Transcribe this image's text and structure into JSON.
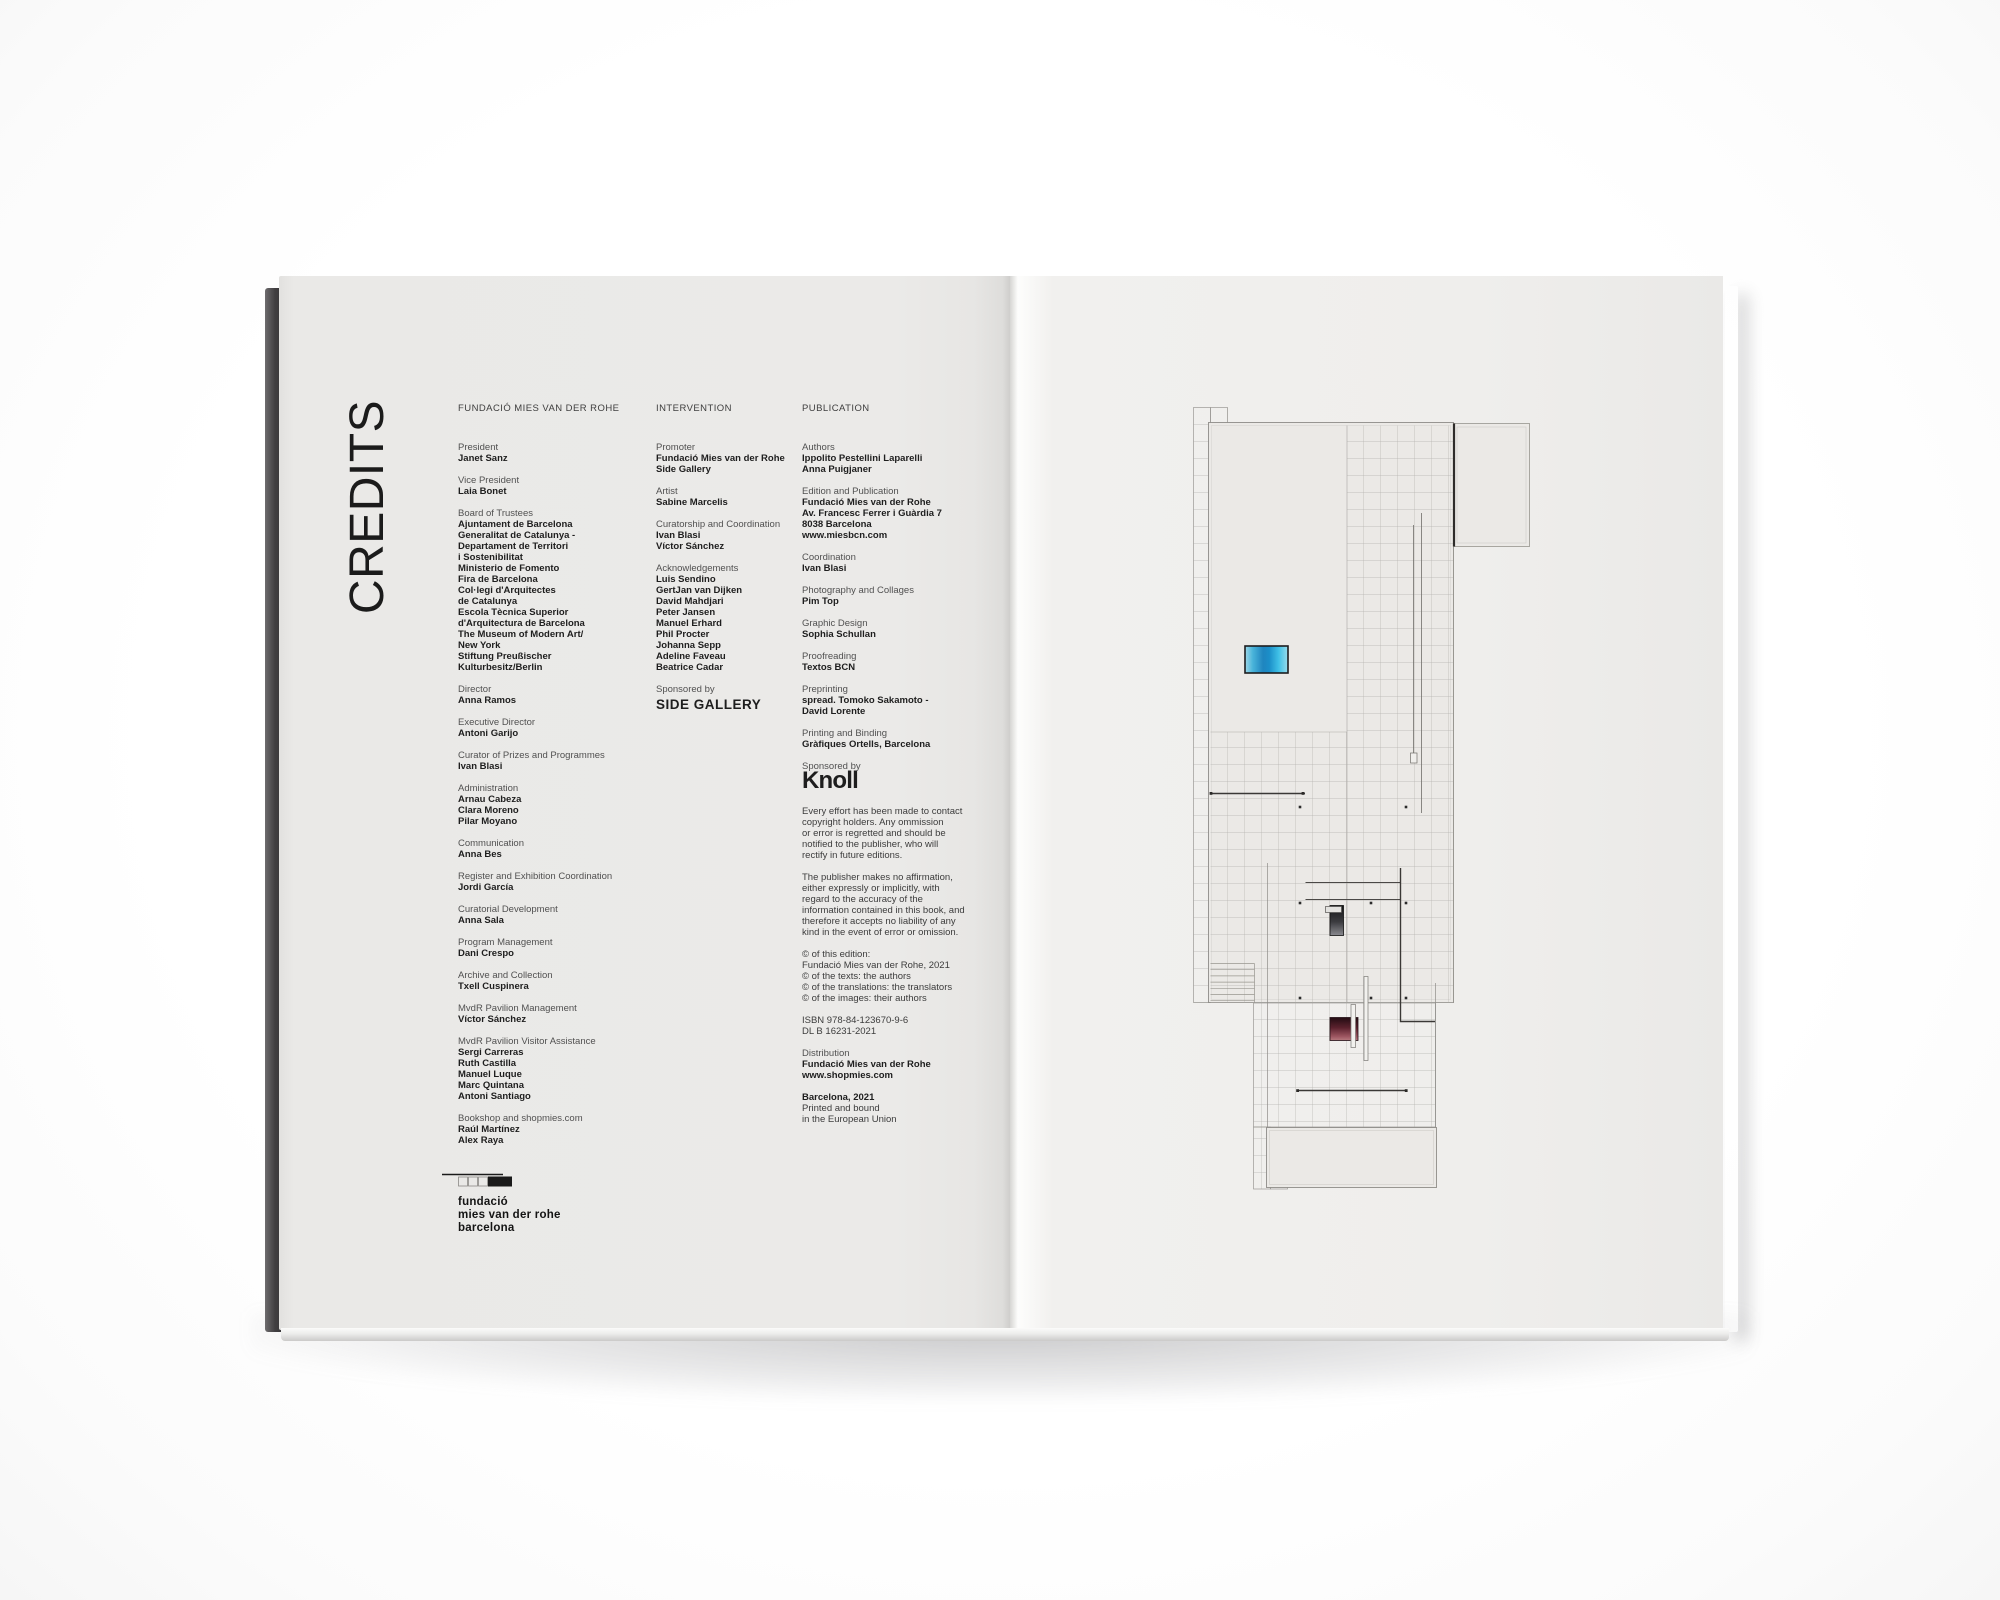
{
  "book": {
    "left_page": {
      "title": "CREDITS",
      "columns": [
        {
          "header": "FUNDACIÓ MIES VAN DER ROHE",
          "sections": [
            {
              "label": "President",
              "bold": [
                "Janet Sanz"
              ]
            },
            {
              "label": "Vice President",
              "bold": [
                "Laia Bonet"
              ]
            },
            {
              "label": "Board of Trustees",
              "bold": [
                "Ajuntament de Barcelona",
                "Generalitat de Catalunya -",
                "Departament de Territori",
                "i Sostenibilitat",
                "Ministerio de Fomento",
                "Fira de Barcelona",
                "Col·legi d'Arquitectes",
                "de Catalunya",
                "Escola Tècnica Superior",
                "d'Arquitectura de Barcelona",
                "The Museum of Modern Art/",
                "New York",
                "Stiftung Preußischer",
                "Kulturbesitz/Berlin"
              ]
            },
            {
              "label": "Director",
              "bold": [
                "Anna Ramos"
              ]
            },
            {
              "label": "Executive Director",
              "bold": [
                "Antoni Garijo"
              ]
            },
            {
              "label": "Curator of Prizes and Programmes",
              "bold": [
                "Ivan Blasi"
              ]
            },
            {
              "label": "Administration",
              "bold": [
                "Arnau Cabeza",
                "Clara Moreno",
                "Pilar Moyano"
              ]
            },
            {
              "label": "Communication",
              "bold": [
                "Anna Bes"
              ]
            },
            {
              "label": "Register and Exhibition Coordination",
              "bold": [
                "Jordi García"
              ]
            },
            {
              "label": "Curatorial Development",
              "bold": [
                "Anna Sala"
              ]
            },
            {
              "label": "Program Management",
              "bold": [
                "Dani Crespo"
              ]
            },
            {
              "label": "Archive and Collection",
              "bold": [
                "Txell Cuspinera"
              ]
            },
            {
              "label": "MvdR Pavilion Management",
              "bold": [
                "Víctor Sánchez"
              ]
            },
            {
              "label": "MvdR Pavilion Visitor Assistance",
              "bold": [
                "Sergi Carreras",
                "Ruth Castilla",
                "Manuel Luque",
                "Marc Quintana",
                "Antoni Santiago"
              ]
            },
            {
              "label": "Bookshop and shopmies.com",
              "bold": [
                "Raúl Martínez",
                "Alex Raya"
              ]
            }
          ]
        },
        {
          "header": "INTERVENTION",
          "sections": [
            {
              "label": "Promoter",
              "bold": [
                "Fundació Mies van der Rohe",
                "Side Gallery"
              ]
            },
            {
              "label": "Artist",
              "bold": [
                "Sabine Marcelis"
              ]
            },
            {
              "label": "Curatorship and Coordination",
              "bold": [
                "Ivan Blasi",
                "Víctor Sánchez"
              ]
            },
            {
              "label": "Acknowledgements",
              "bold": [
                "Luis Sendino",
                "GertJan van Dijken",
                "David Mahdjari",
                "Peter Jansen",
                "Manuel Erhard",
                "Phil Procter",
                "Johanna Sepp",
                "Adeline Faveau",
                "Beatrice Cadar"
              ]
            },
            {
              "label": "Sponsored by",
              "bold": [
                "SIDE GALLERY"
              ],
              "cls": "sponsor-side"
            }
          ]
        },
        {
          "header": "PUBLICATION",
          "sections": [
            {
              "label": "Authors",
              "bold": [
                "Ippolito Pestellini Laparelli",
                "Anna Puigjaner"
              ]
            },
            {
              "label": "Edition and Publication",
              "bold": [
                "Fundació Mies van der Rohe",
                "Av. Francesc Ferrer i Guàrdia 7",
                "8038 Barcelona",
                "www.miesbcn.com"
              ]
            },
            {
              "label": "Coordination",
              "bold": [
                "Ivan Blasi"
              ]
            },
            {
              "label": "Photography and Collages",
              "bold": [
                "Pim Top"
              ]
            },
            {
              "label": "Graphic Design",
              "bold": [
                "Sophia Schullan"
              ]
            },
            {
              "label": "Proofreading",
              "bold": [
                "Textos BCN"
              ]
            },
            {
              "label": "Preprinting",
              "bold": [
                "spread. Tomoko Sakamoto -",
                "David Lorente"
              ]
            },
            {
              "label": "Printing and Binding",
              "bold": [
                "Gràfiques Ortells, Barcelona"
              ]
            },
            {
              "label": "Sponsored by",
              "bold": [
                "Knoll"
              ],
              "cls": "sponsor-knoll"
            },
            {
              "plain": [
                "Every effort has been made to contact",
                "copyright holders. Any ommission",
                "or error is regretted and should be",
                "notified to the publisher, who will",
                "rectify in future editions."
              ],
              "cls": "para-first"
            },
            {
              "plain": [
                "The publisher makes no affirmation,",
                "either expressly or implicitly, with",
                "regard to the accuracy of the",
                "information contained in this book, and",
                "therefore it accepts no liability of any",
                "kind in the event of error or omission."
              ]
            },
            {
              "plain": [
                "© of this edition:",
                "Fundació Mies van der Rohe, 2021",
                "© of the texts: the authors",
                "© of the translations: the translators",
                "© of the images: their authors"
              ]
            },
            {
              "plain": [
                "ISBN 978-84-123670-9-6",
                "DL B 16231-2021"
              ]
            },
            {
              "label": "Distribution",
              "bold": [
                "Fundació Mies van der Rohe",
                "www.shopmies.com"
              ]
            },
            {
              "bold": [
                "Barcelona, 2021"
              ],
              "plain": [
                "Printed and bound",
                "in the European Union"
              ]
            }
          ]
        }
      ],
      "logo": {
        "line1": "fundació",
        "line2": "mies van der rohe",
        "line3": "barcelona"
      }
    },
    "colors": {
      "pool_blue": "#1f85bf",
      "onyx_red": "#5c222e",
      "cover_dark": "#413f41",
      "page_gray": "#ebeae8",
      "text_black": "#1e1e1e"
    }
  }
}
